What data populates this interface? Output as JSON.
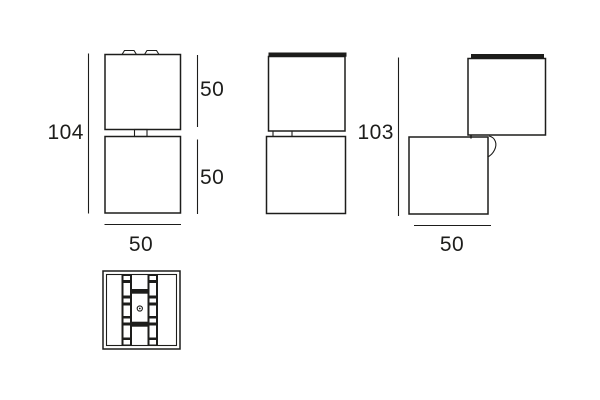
{
  "drawing": {
    "colors": {
      "line": "#1d1d1b",
      "background": "#ffffff"
    },
    "views": {
      "front": {
        "dim_total_height": "104",
        "dim_top_module_height": "50",
        "dim_bottom_module_height": "50",
        "dim_width": "50"
      },
      "rotated": {
        "dim_total_height": "103",
        "dim_width": "50"
      }
    }
  }
}
